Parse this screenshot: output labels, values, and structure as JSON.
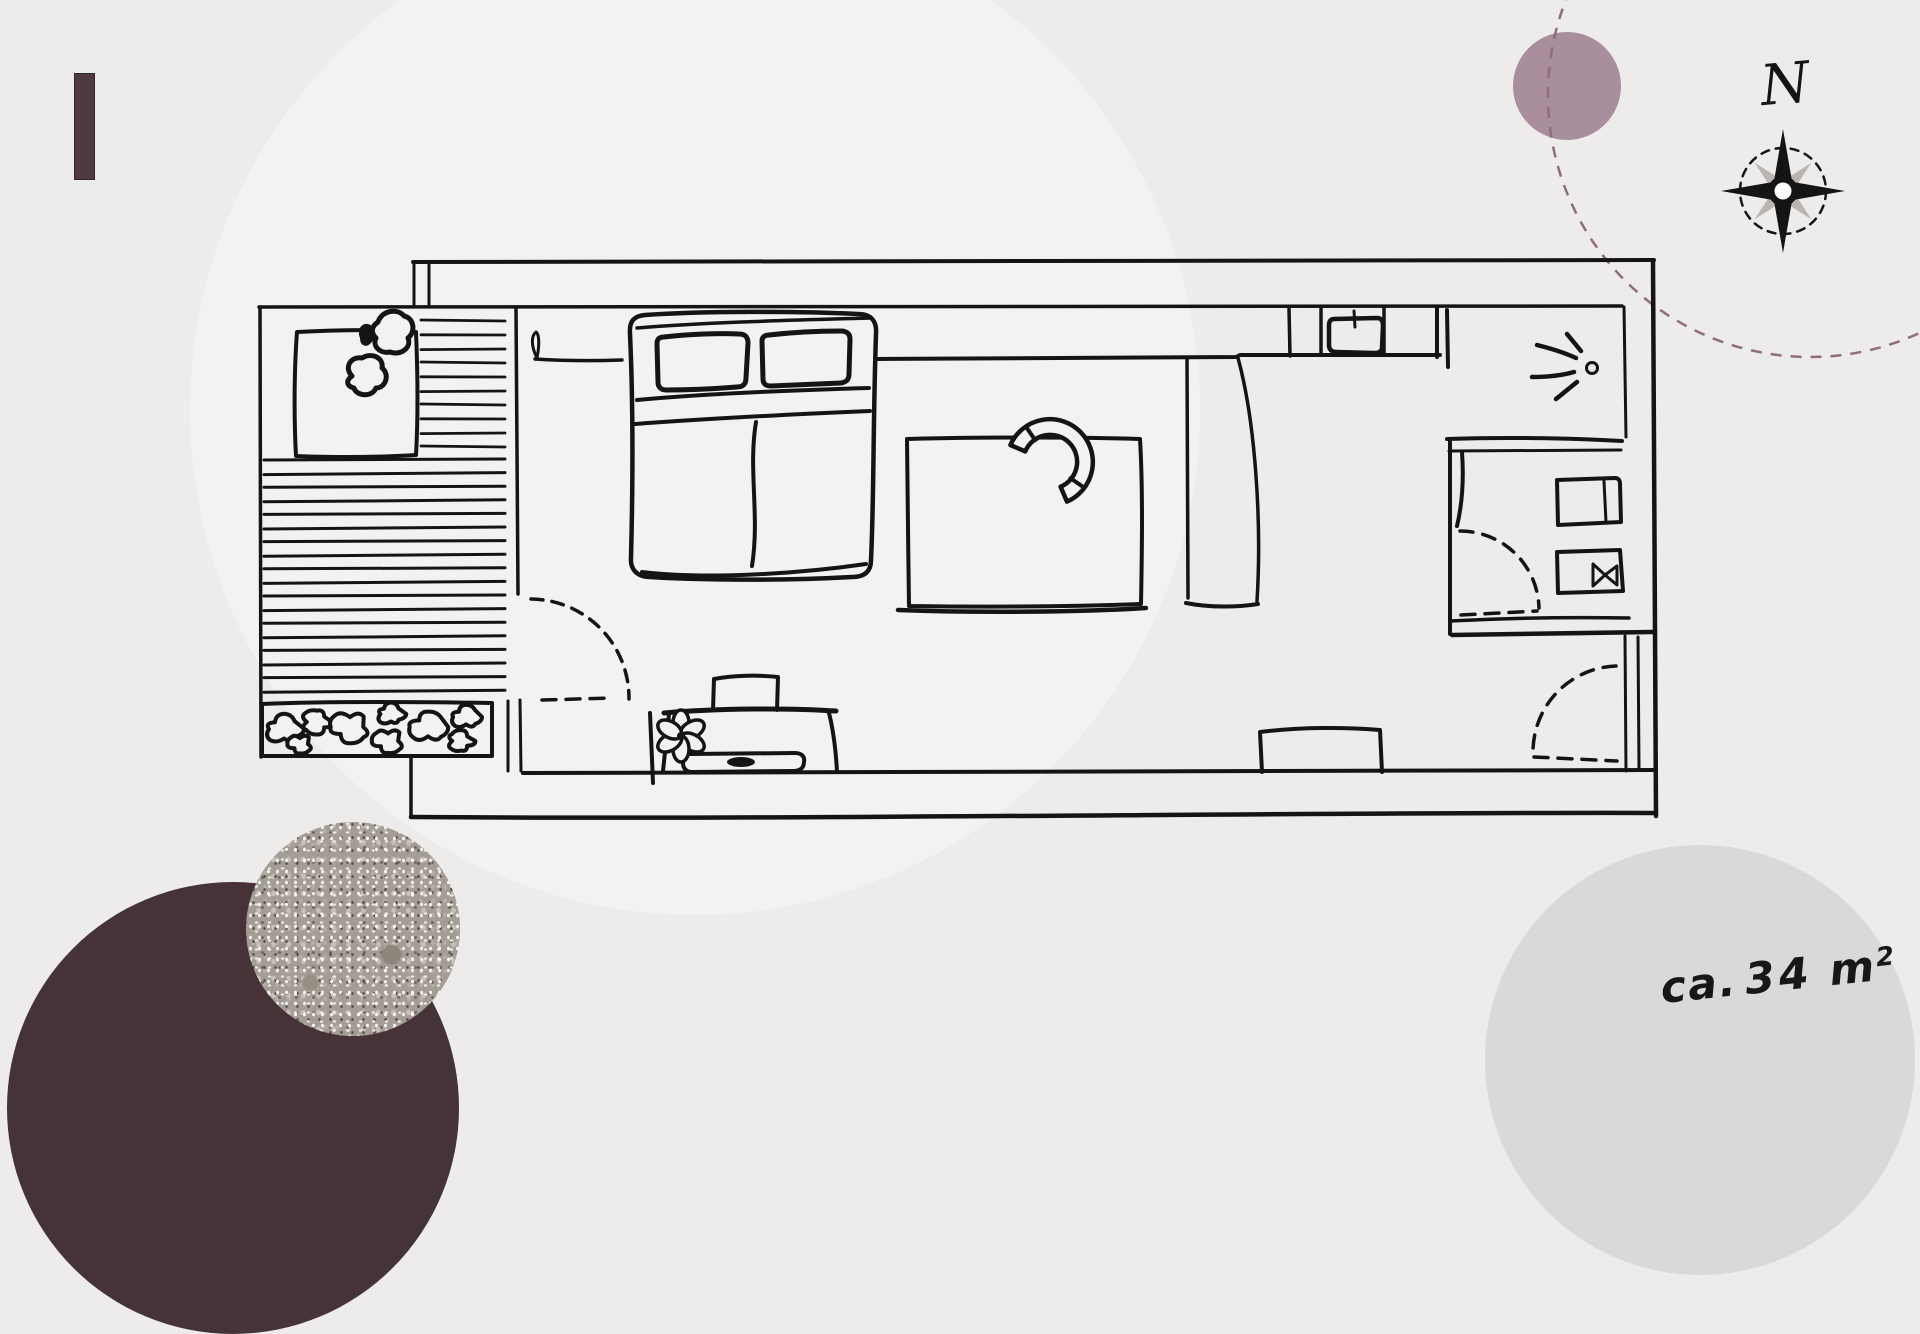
{
  "labels": {
    "north": "N",
    "area": {
      "prefix": "ca.",
      "value": "34",
      "unit": "m",
      "exponent": "2"
    }
  },
  "colors": {
    "bg": "#edeceb",
    "circle": "#f3f2f0",
    "ink": "#141414",
    "mauve": "#a98e9e",
    "mauveDash": "#8f6c80",
    "plum": "#463338",
    "bar": "#4e3a40",
    "barBorder": "#33272b",
    "lightCircle": "#dbd9d8",
    "terrazzo": "#a39d95",
    "compassGray": "#b8b5b3"
  },
  "icons": {
    "compass": "compass-rose-icon",
    "wall_light": "light-rays-icon",
    "plant": "potted-plant-icon",
    "flower": "flower-icon",
    "sink": "kitchen-sink-icon"
  }
}
